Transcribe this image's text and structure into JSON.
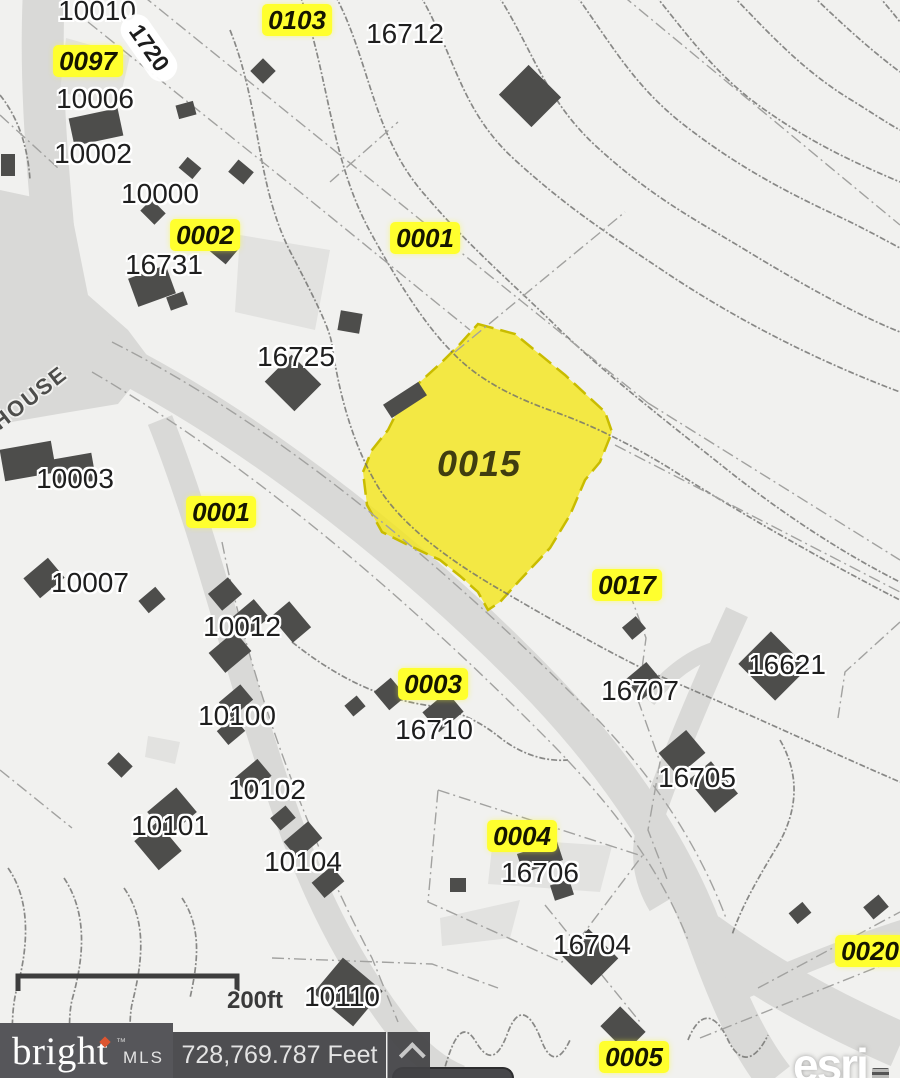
{
  "map": {
    "highlighted_parcel": {
      "label": "0015",
      "x": 479,
      "y": 464
    },
    "parcel_labels": [
      {
        "label": "0103",
        "x": 297,
        "y": 20
      },
      {
        "label": "0097",
        "x": 88,
        "y": 61
      },
      {
        "label": "0002",
        "x": 205,
        "y": 235
      },
      {
        "label": "0001",
        "x": 425,
        "y": 238
      },
      {
        "label": "0001",
        "x": 221,
        "y": 512
      },
      {
        "label": "0017",
        "x": 627,
        "y": 585
      },
      {
        "label": "0003",
        "x": 433,
        "y": 684
      },
      {
        "label": "0004",
        "x": 522,
        "y": 836
      },
      {
        "label": "0020",
        "x": 870,
        "y": 951
      },
      {
        "label": "0005",
        "x": 634,
        "y": 1057
      }
    ],
    "address_labels": [
      {
        "label": "10010",
        "x": 97,
        "y": 11
      },
      {
        "label": "16712",
        "x": 405,
        "y": 34
      },
      {
        "label": "10006",
        "x": 95,
        "y": 99
      },
      {
        "label": "10002",
        "x": 93,
        "y": 154
      },
      {
        "label": "10000",
        "x": 160,
        "y": 194
      },
      {
        "label": "16731",
        "x": 164,
        "y": 265
      },
      {
        "label": "16725",
        "x": 296,
        "y": 357
      },
      {
        "label": "10003",
        "x": 75,
        "y": 479
      },
      {
        "label": "10007",
        "x": 90,
        "y": 583
      },
      {
        "label": "10012",
        "x": 242,
        "y": 627
      },
      {
        "label": "16621",
        "x": 787,
        "y": 665
      },
      {
        "label": "16707",
        "x": 640,
        "y": 691
      },
      {
        "label": "10100",
        "x": 237,
        "y": 716
      },
      {
        "label": "16710",
        "x": 434,
        "y": 730
      },
      {
        "label": "16705",
        "x": 697,
        "y": 778
      },
      {
        "label": "10102",
        "x": 267,
        "y": 790
      },
      {
        "label": "10101",
        "x": 170,
        "y": 826
      },
      {
        "label": "10104",
        "x": 303,
        "y": 862
      },
      {
        "label": "16706",
        "x": 540,
        "y": 873
      },
      {
        "label": "16704",
        "x": 592,
        "y": 945
      },
      {
        "label": "10110",
        "x": 342,
        "y": 997
      }
    ],
    "road_labels": [
      {
        "text": "1720",
        "x": 149,
        "y": 48,
        "rot": 55,
        "style": "shield"
      },
      {
        "text": "HOUSE",
        "x": 30,
        "y": 398,
        "rot": -38,
        "style": "street"
      }
    ],
    "scale_bar": {
      "label": "200ft",
      "x": 255,
      "y": 1001
    }
  },
  "footer": {
    "brand": {
      "name": "bright",
      "suffix": "MLS",
      "tm": "™"
    },
    "measurement": "728,769.787 Feet",
    "attribution": "esri"
  },
  "colors": {
    "parcel_highlight": "#f3e51e",
    "parcel_label_bg": "#ffff2e",
    "road": "#d9d9d7",
    "building": "#4d4d4b"
  }
}
